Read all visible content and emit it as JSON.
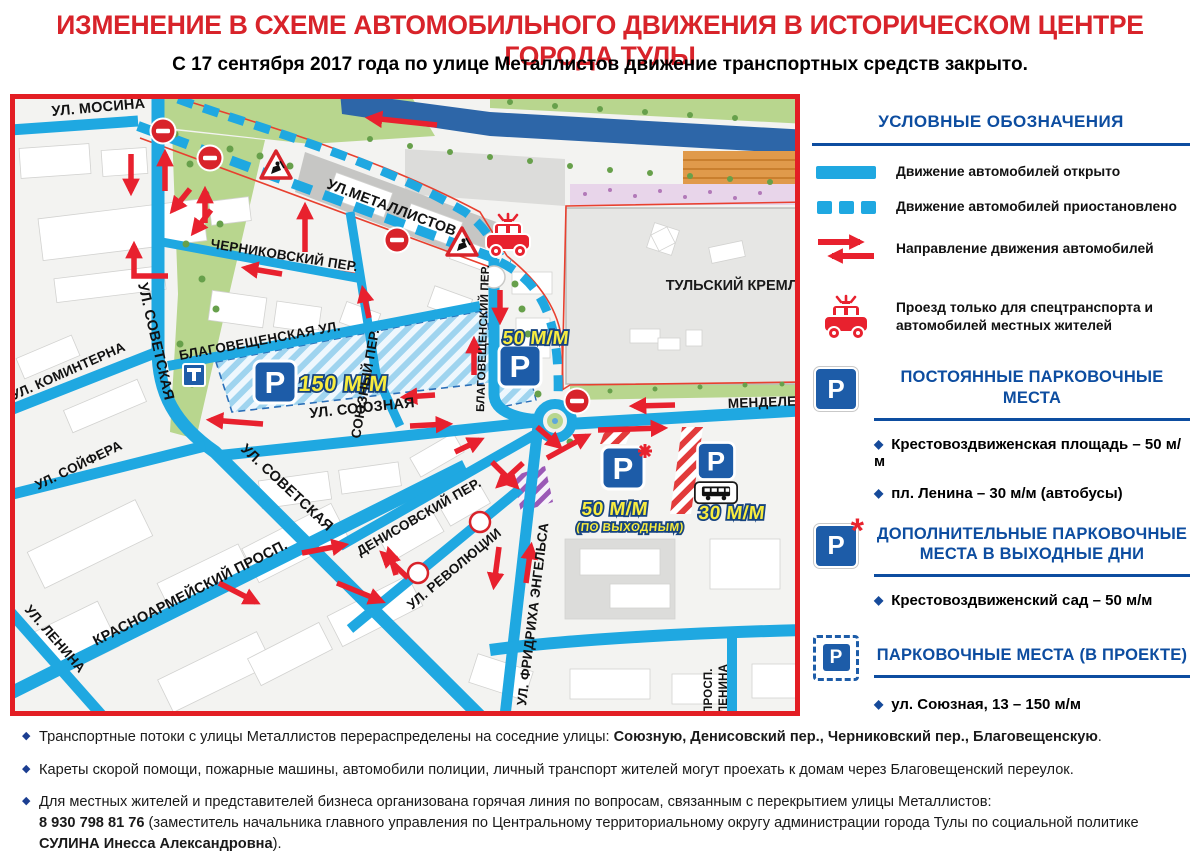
{
  "header": {
    "title": "ИЗМЕНЕНИЕ В СХЕМЕ АВТОМОБИЛЬНОГО ДВИЖЕНИЯ В ИСТОРИЧЕСКОМ ЦЕНТРЕ ГОРОДА ТУЛЫ",
    "subtitle": "С 17 сентября 2017 года по улице Металлистов движение транспортных средств закрыто."
  },
  "colors": {
    "accent_red": "#d8232a",
    "road_blue": "#1fa8e1",
    "heading_blue": "#0d4da0",
    "sign_blue": "#1d5ca8",
    "marker_yellow": "#f8ec3f"
  },
  "icons": {
    "p_glyph": "P",
    "asterisk": "*"
  },
  "map": {
    "street_labels": [
      {
        "text": "УЛ. МОСИНА"
      },
      {
        "text": "УЛ. СОВЕТСКАЯ"
      },
      {
        "text": "УЛ. КОМИНТЕРНА"
      },
      {
        "text": "ЧЕРНИКОВСКИЙ ПЕР."
      },
      {
        "text": "УЛ.МЕТАЛЛИСТОВ"
      },
      {
        "text": "СОЮЗНЫЙ ПЕР."
      },
      {
        "text": "БЛАГОВЕЩЕНСКАЯ УЛ."
      },
      {
        "text": "УЛ. СОЮЗНАЯ"
      },
      {
        "text": "УЛ. СОЙФЕРА"
      },
      {
        "text": "УЛ. СОВЕТСКАЯ"
      },
      {
        "text": "КРАСНОАРМЕЙСКИЙ ПРОСП."
      },
      {
        "text": "УЛ. ЛЕНИНА"
      },
      {
        "text": "ДЕНИСОВСКИЙ ПЕР."
      },
      {
        "text": "УЛ. РЕВОЛЮЦИИ"
      },
      {
        "text": "УЛ. ФРИДРИХА ЭНГЕЛЬСА"
      },
      {
        "text": "БЛАГОВЕЩЕНСКИЙ ПЕР."
      },
      {
        "text": "МЕНДЕЛЕЕВ"
      },
      {
        "text": "ПРОСП."
      },
      {
        "text": "ЛЕНИНА"
      }
    ],
    "area_label": "ТУЛЬСКИЙ КРЕМЛЬ",
    "parking_markers": {
      "p150": {
        "label": "150 М/М"
      },
      "p50": {
        "label": "50 М/М"
      },
      "p50w": {
        "label": "50 М/М",
        "sublabel": "(ПО ВЫХОДНЫМ)"
      },
      "p30": {
        "label": "30 М/М"
      }
    }
  },
  "legend": {
    "title": "УСЛОВНЫЕ ОБОЗНАЧЕНИЯ",
    "items": [
      {
        "icon": "solid-blue-line",
        "label": "Движение автомобилей открыто"
      },
      {
        "icon": "dashed-blue-line",
        "label": "Движение автомобилей приостановлено"
      },
      {
        "icon": "two-way-red-arrows",
        "label": "Направление движения автомобилей"
      },
      {
        "icon": "special-transport-car",
        "label": "Проезд только для спецтранспорта и автомобилей местных жителей"
      }
    ]
  },
  "parking_sections": [
    {
      "icon": "parking-sign",
      "title": "ПОСТОЯННЫЕ ПАРКОВОЧНЫЕ МЕСТА",
      "items": [
        "Крестовоздвиженская площадь – 50 м/м",
        "пл. Ленина – 30 м/м (автобусы)"
      ]
    },
    {
      "icon": "parking-sign-asterisk",
      "title": "ДОПОЛНИТЕЛЬНЫЕ ПАРКОВОЧНЫЕ МЕСТА В ВЫХОДНЫЕ ДНИ",
      "items": [
        "Крестовоздвиженский сад – 50 м/м"
      ]
    },
    {
      "icon": "parking-sign-dashed",
      "title": "ПАРКОВОЧНЫЕ МЕСТА (В ПРОЕКТЕ)",
      "items": [
        "ул. Союзная, 13 – 150 м/м"
      ]
    }
  ],
  "notes": [
    {
      "segments": [
        {
          "text": "Транспортные потоки с улицы Металлистов перераспределены на соседние улицы: "
        },
        {
          "text": "Союзную, Денисовский пер., Черниковский пер., Благовещенскую"
        },
        {
          "text": "."
        }
      ]
    },
    {
      "segments": [
        {
          "text": "Кареты скорой помощи, пожарные машины, автомобили полиции, личный транспорт жителей могут проехать к домам через Благовещенский переулок."
        }
      ]
    },
    {
      "segments": [
        {
          "text": "Для местных жителей и представителей бизнеса организована горячая линия по вопросам, связанным с перекрытием улицы Металлистов:"
        },
        {
          "text": "8 930 798 81 76"
        },
        {
          "text": " (заместитель начальника главного управления по Центральному территориальному округу администрации города Тулы по социальной политике "
        },
        {
          "text": "СУЛИНА Инесса Александровна"
        },
        {
          "text": ")."
        }
      ]
    }
  ]
}
